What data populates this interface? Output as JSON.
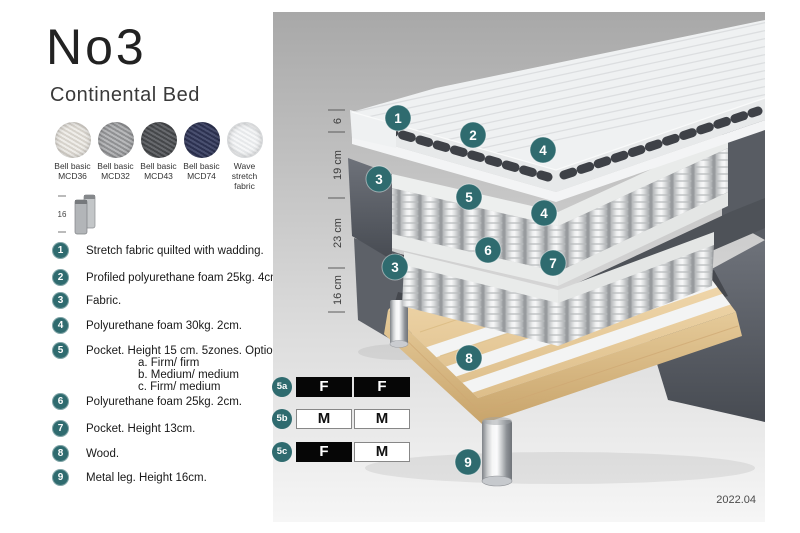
{
  "header": {
    "title": "No3",
    "subtitle": "Continental Bed"
  },
  "fabrics": [
    {
      "line1": "Bell basic",
      "line2": "MCD36",
      "color": "#d6d2cb"
    },
    {
      "line1": "Bell basic",
      "line2": "MCD32",
      "color": "#8f9092"
    },
    {
      "line1": "Bell basic",
      "line2": "MCD43",
      "color": "#45474a"
    },
    {
      "line1": "Bell basic",
      "line2": "MCD74",
      "color": "#2c3150"
    },
    {
      "line1": "Wave",
      "line2": "stretch fabric",
      "color": "#e6e8ea"
    }
  ],
  "leg_icon": {
    "height_label": "16"
  },
  "legend_items": [
    {
      "num": "1",
      "text": "Stretch fabric quilted with wadding."
    },
    {
      "num": "2",
      "text": "Profiled polyurethane foam 25kg. 4cm."
    },
    {
      "num": "3",
      "text": "Fabric."
    },
    {
      "num": "4",
      "text": "Polyurethane foam 30kg. 2cm."
    },
    {
      "num": "5",
      "text": "Pocket. Height 15 cm. 5zones. Option:",
      "options": [
        "a. Firm/ firm",
        "b. Medium/ medium",
        "c. Firm/ medium"
      ]
    },
    {
      "num": "6",
      "text": "Polyurethane foam 25kg. 2cm."
    },
    {
      "num": "7",
      "text": "Pocket. Height 13cm."
    },
    {
      "num": "8",
      "text": "Wood."
    },
    {
      "num": "9",
      "text": "Metal leg. Height 16cm."
    }
  ],
  "diagram": {
    "dimensions": [
      "6",
      "19 cm",
      "23 cm",
      "16 cm"
    ],
    "markers": [
      "1",
      "2",
      "4",
      "3",
      "5",
      "4",
      "6",
      "7",
      "3",
      "8",
      "9"
    ],
    "firmness": {
      "rows": [
        {
          "label": "5a",
          "cells": [
            {
              "letter": "F",
              "variant": "dark"
            },
            {
              "letter": "F",
              "variant": "dark"
            }
          ]
        },
        {
          "label": "5b",
          "cells": [
            {
              "letter": "M",
              "variant": "light"
            },
            {
              "letter": "M",
              "variant": "light"
            }
          ]
        },
        {
          "label": "5c",
          "cells": [
            {
              "letter": "F",
              "variant": "dark"
            },
            {
              "letter": "M",
              "variant": "light"
            }
          ]
        }
      ]
    },
    "revision": "2022.04",
    "colors": {
      "accent_teal": "#2f6b6f",
      "background_top": "#a8a8a8",
      "background_bottom": "#f6f6f6",
      "wood": "#e9cf9f",
      "dark_fabric": "#565a61",
      "black_cell": "#060606"
    }
  }
}
